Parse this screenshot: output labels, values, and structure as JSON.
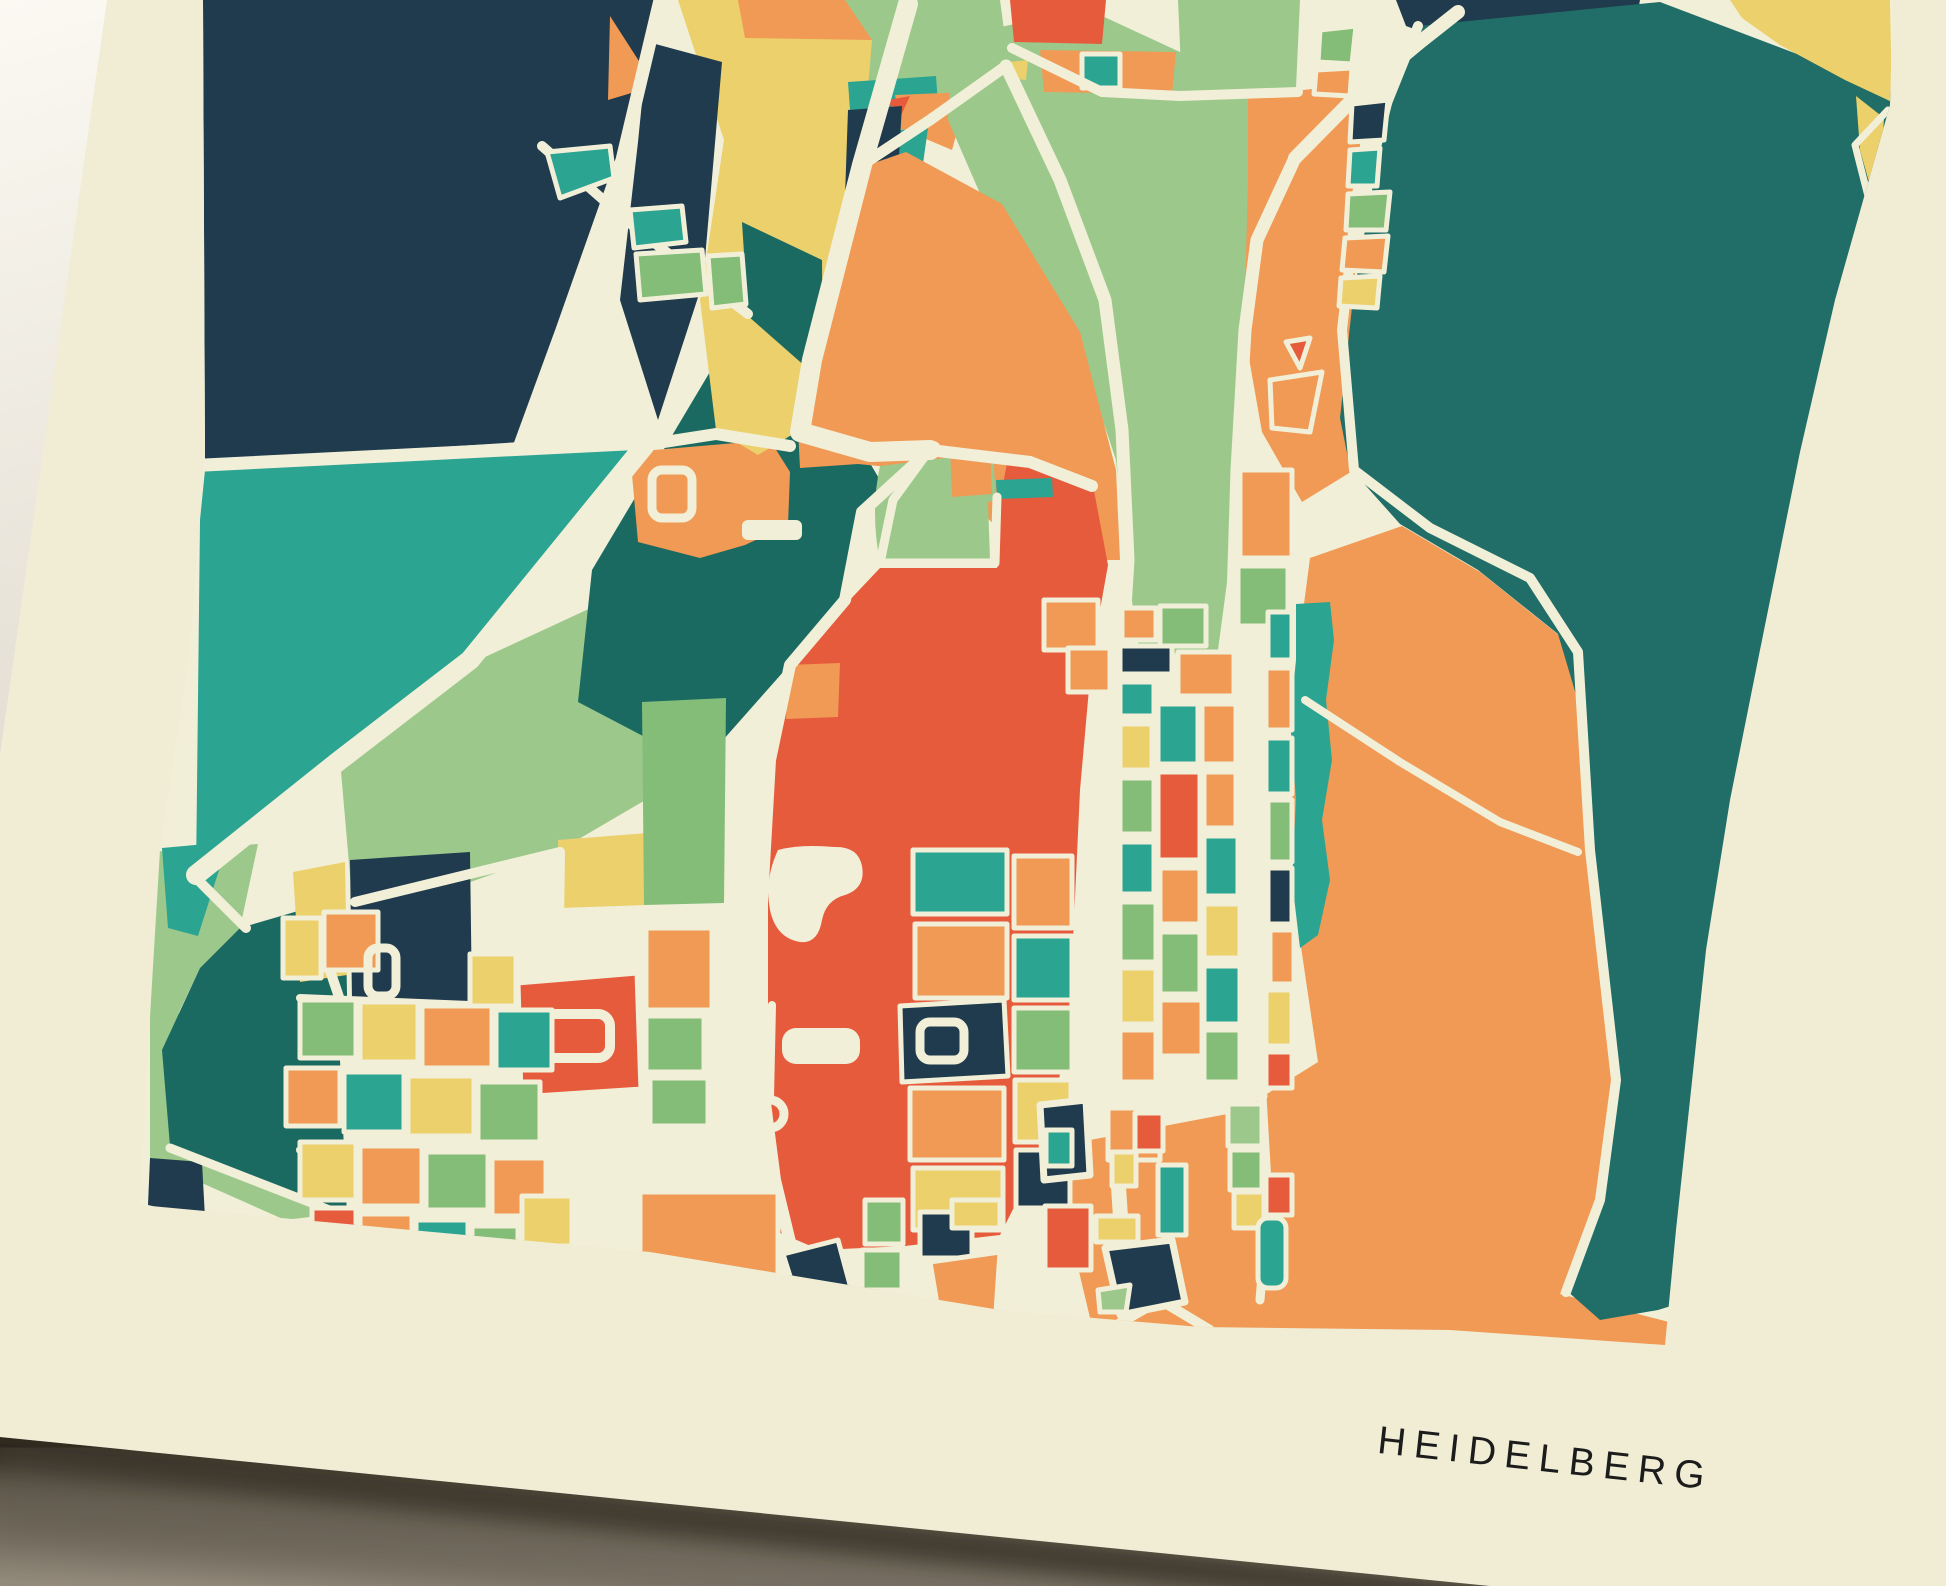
{
  "scene": {
    "description": "photograph of a map art print lying on a surface",
    "surface_light_color": "#fbf9f2",
    "surface_dark_color": "#8e8679",
    "shadow_color": "#262219"
  },
  "poster": {
    "title": "HEIDELBERG",
    "title_color": "#1c1c1c",
    "paper_color": "#f0edd4"
  },
  "map": {
    "style": "abstract multicolor city parcel map",
    "road_color": "#f2efd8",
    "palette": {
      "navy": "#1f3b4d",
      "forest_teal": "#206e67",
      "dark_teal": "#1a6a62",
      "teal": "#2ba492",
      "light_green": "#9cc98b",
      "green": "#83bd78",
      "yellow": "#ecd06c",
      "orange": "#f09a55",
      "red_orange": "#e75b3d"
    }
  }
}
